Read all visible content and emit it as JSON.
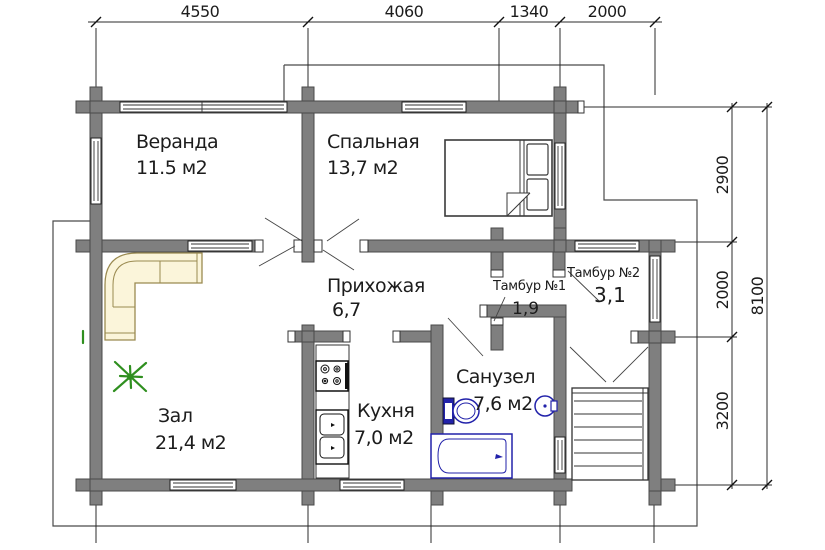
{
  "plan": {
    "rooms": [
      {
        "name": "Веранда",
        "area": "11.5 м2"
      },
      {
        "name": "Спальная",
        "area": "13,7 м2"
      },
      {
        "name": "Прихожая",
        "area": "6,7"
      },
      {
        "name": "Тамбур №1",
        "area": "1,9"
      },
      {
        "name": "Тамбур №2",
        "area": "3,1"
      },
      {
        "name": "Зал",
        "area": "21,4 м2"
      },
      {
        "name": "Кухня",
        "area": "7,0 м2"
      },
      {
        "name": "Санузел",
        "area": "7,6 м2"
      }
    ],
    "dims_top": [
      "4550",
      "4060",
      "1340",
      "2000"
    ],
    "dims_right": [
      "2900",
      "2000",
      "3200"
    ],
    "dim_total_right": "8100",
    "colors": {
      "wall": "#7f7f7f",
      "wall_edge": "#4a4a4a",
      "fixture_blue": "#2222aa",
      "sofa_fill": "#fbf5da",
      "sofa_edge": "#9a8a50",
      "plant_green": "#2f8f1f"
    }
  }
}
